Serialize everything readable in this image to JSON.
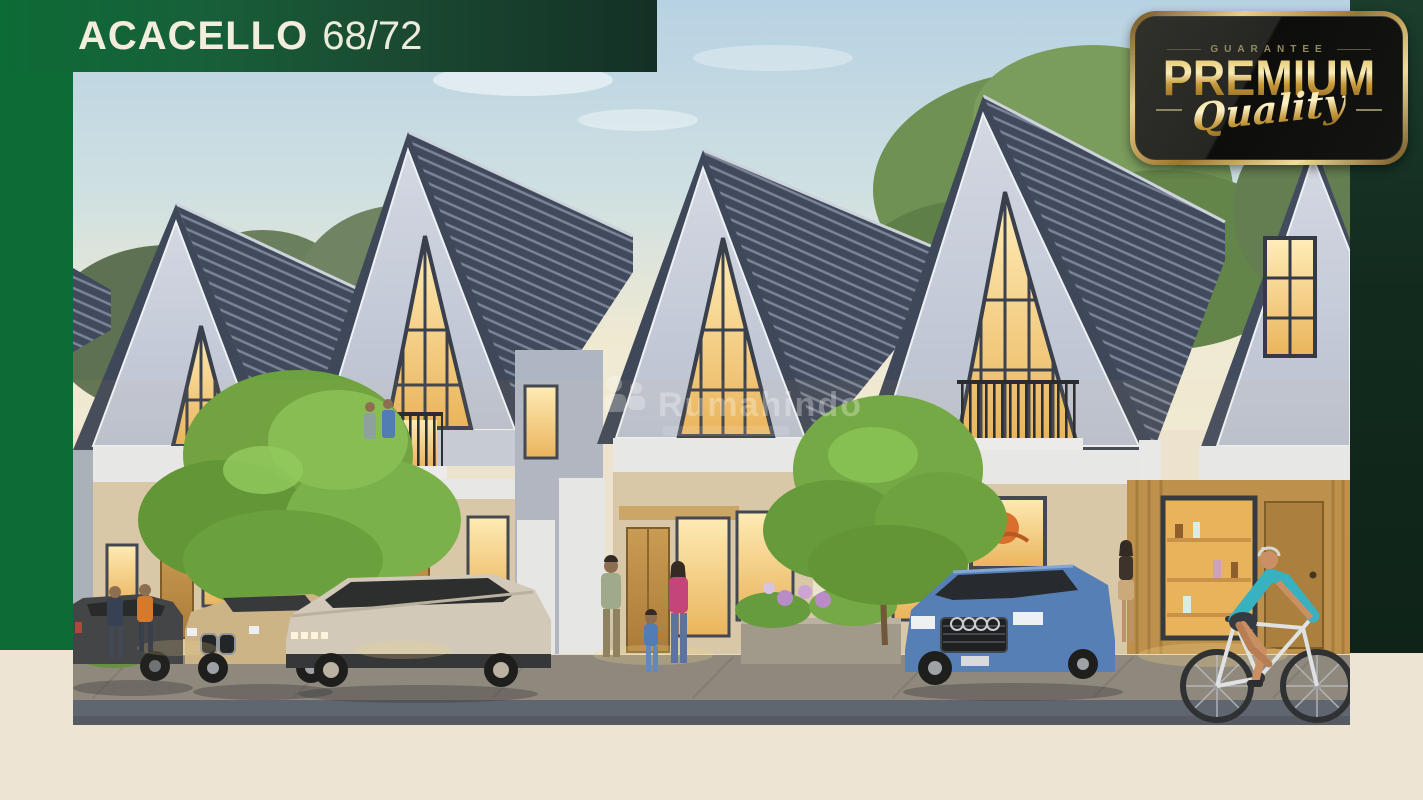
{
  "header": {
    "project_name": "ACACELLO",
    "unit_type": "68/72"
  },
  "badge": {
    "guarantee": "GUARANTEE",
    "premium": "PREMIUM",
    "quality": "Quality"
  },
  "watermark": {
    "name": "Rumahindo"
  },
  "colors": {
    "green_primary": "#0D6B35",
    "green_header_dark": "#143026",
    "green_right_dark": "#122A1E",
    "cream": "#EDE4D3",
    "gold": "#D9B567",
    "badge_black": "#131311",
    "title_text": "#F2EDDC"
  }
}
